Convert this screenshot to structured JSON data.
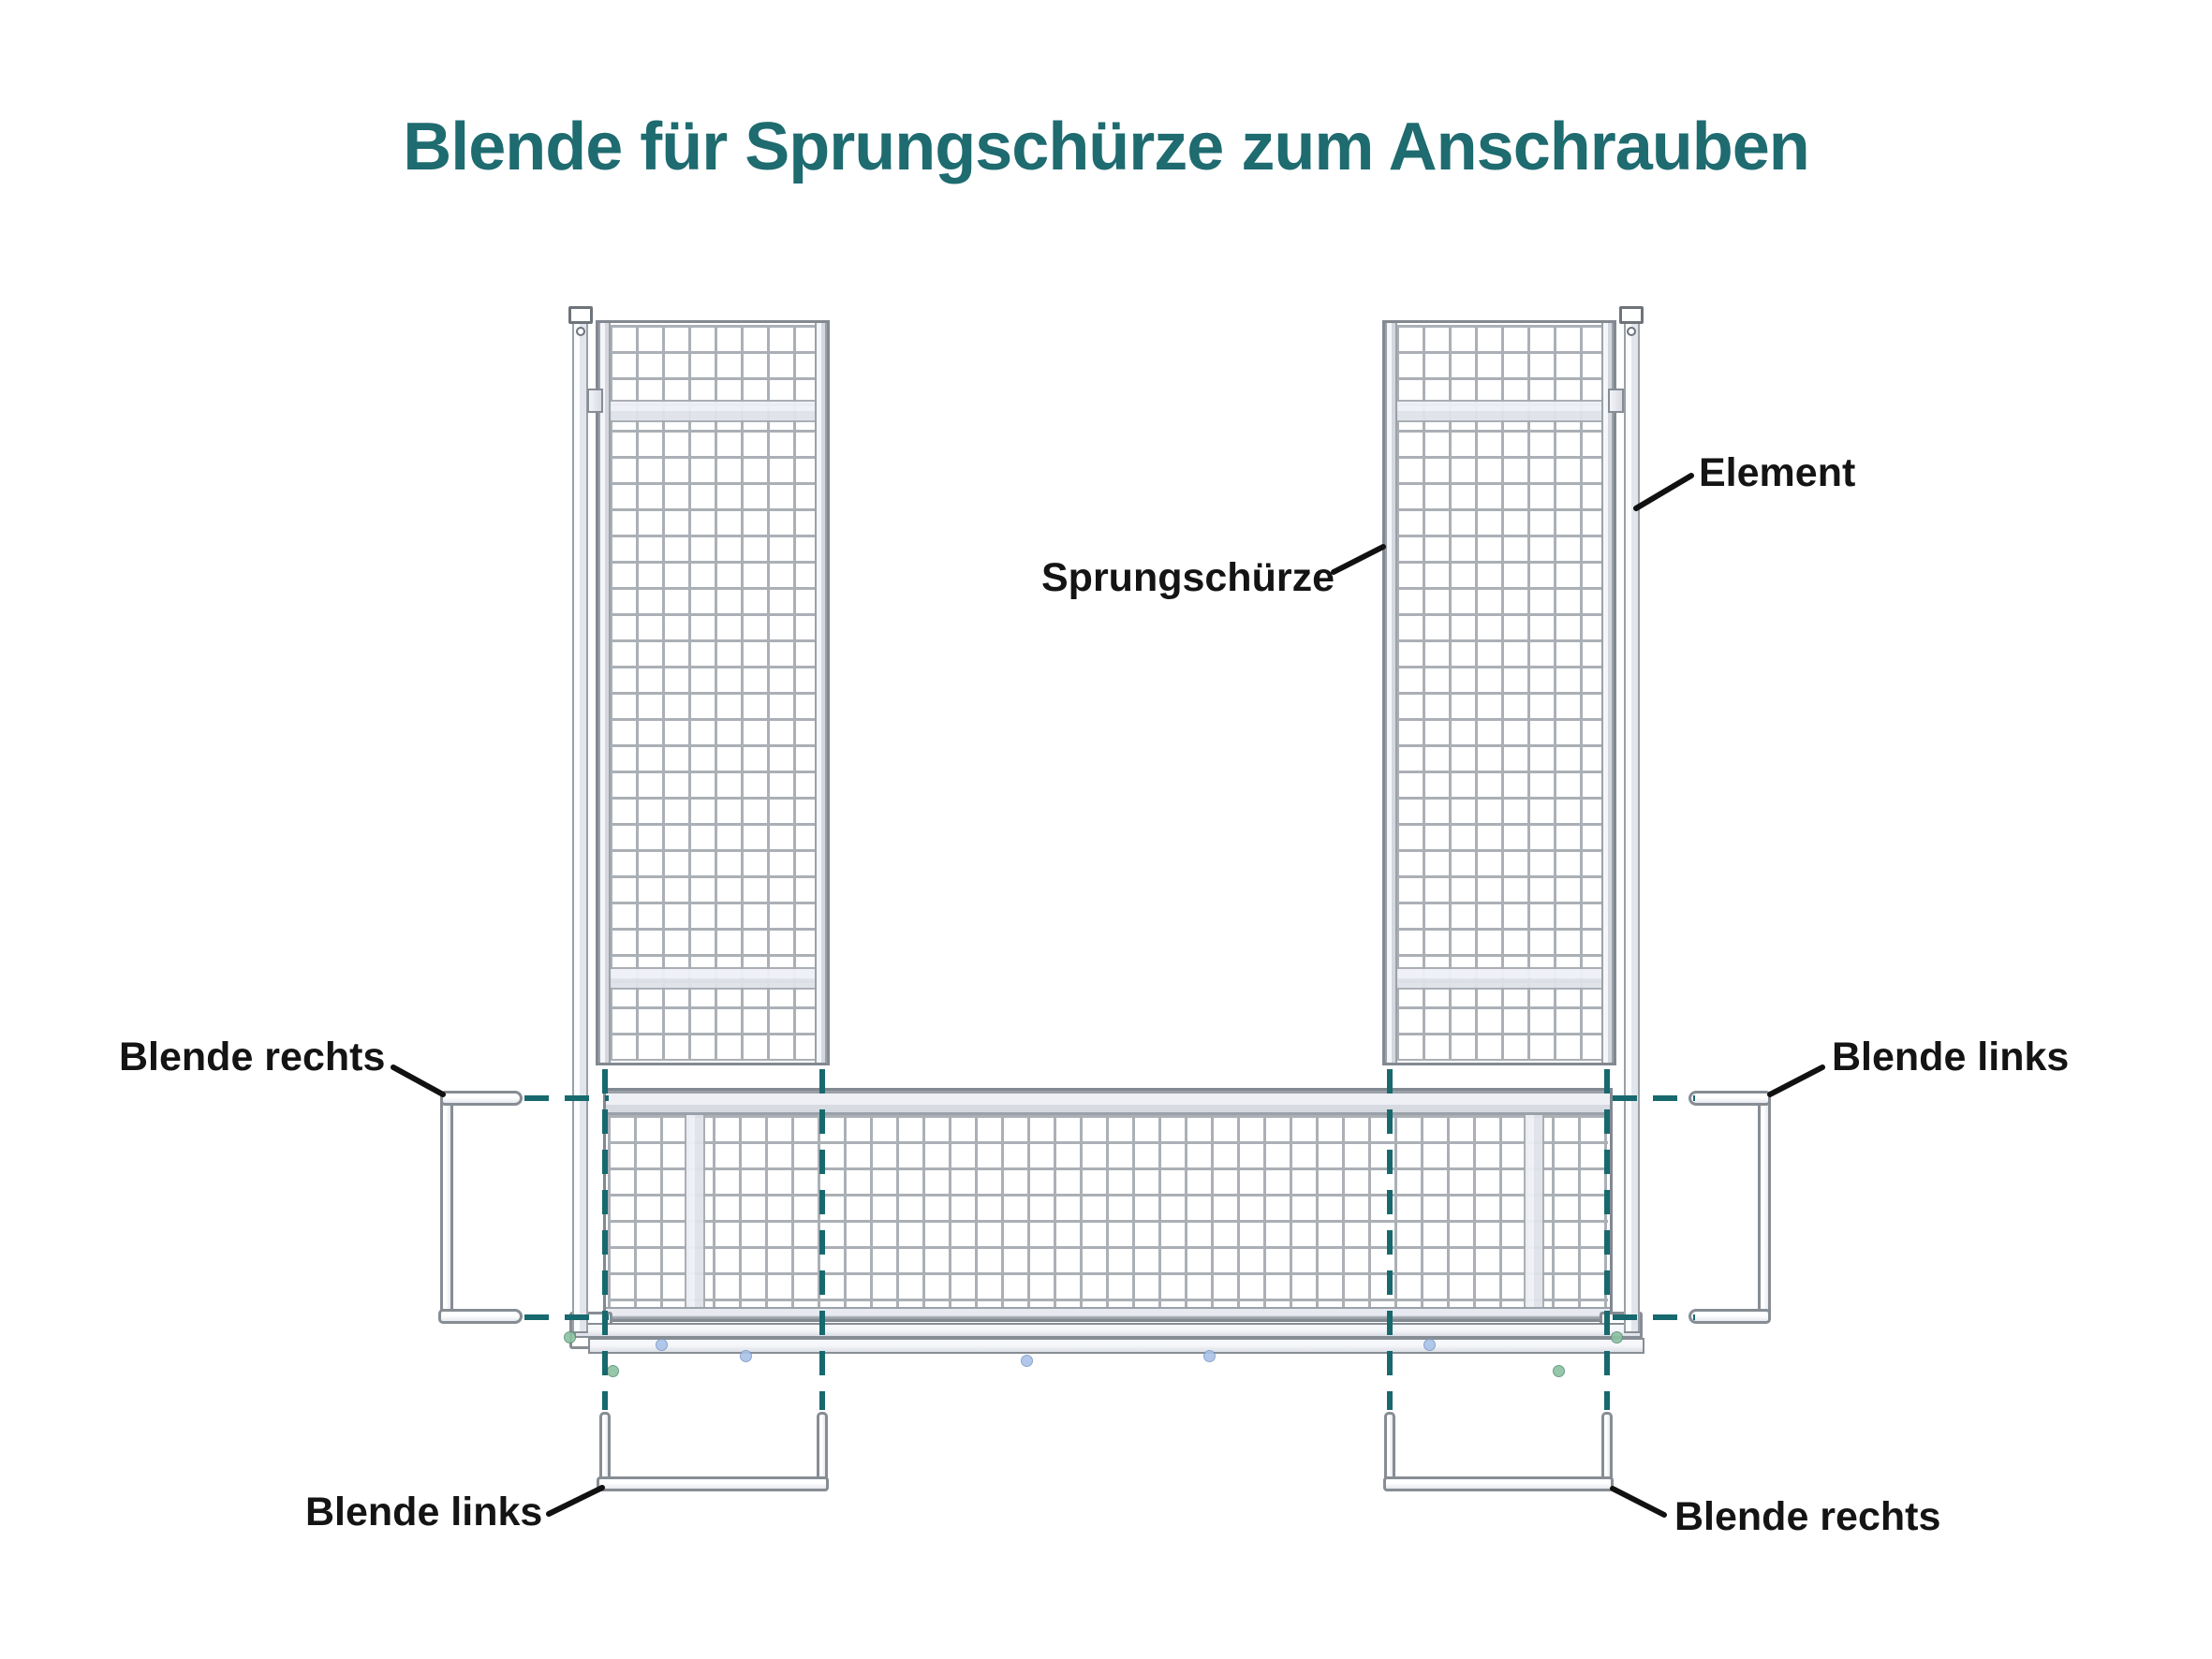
{
  "title": "Blende für Sprungschürze zum Anschrauben",
  "labels": {
    "element": "Element",
    "sprungschuerze": "Sprungschürze",
    "blende_rechts_mid": "Blende rechts",
    "blende_links_mid": "Blende links",
    "blende_links_bottom": "Blende links",
    "blende_rechts_bottom": "Blende rechts"
  },
  "colors": {
    "teal-title": "#1e6b70",
    "teal-dash": "#17696e",
    "ink": "#141414",
    "line-gray": "#838991",
    "mesh-gray": "#abb0b6"
  }
}
